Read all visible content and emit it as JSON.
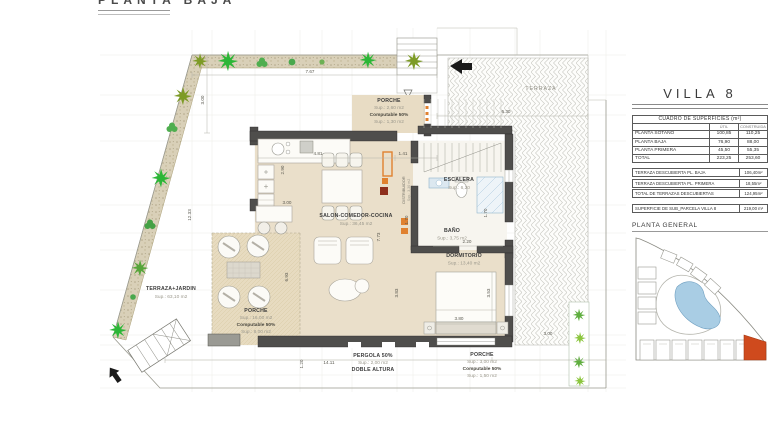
{
  "sheet": {
    "title": "PLANTA BAJA"
  },
  "plan": {
    "rooms": {
      "porche_top": {
        "name": "PORCHE",
        "sup": "Sup.: 2,60   m2",
        "comp": "Computable 50%",
        "comp_sup": "Sup.: 1,30   m2"
      },
      "salon": {
        "name": "SALON-COMEDOR-COCINA",
        "sup": "Sup.: 36,45 m2"
      },
      "escalera": {
        "name": "ESCALERA",
        "sup": "Sup.: 6,20"
      },
      "bano": {
        "name": "BAÑO",
        "sup": "Sup.: 3,75   m2"
      },
      "distribuidor": {
        "name": "DISTRIBUIDOR",
        "sup": "Sup.: 3,30  m2"
      },
      "dormitorio": {
        "name": "DORMITORIO",
        "sup": "Sup.: 13,40  m2"
      },
      "terraza_jardin": {
        "name": "TERRAZA+JARDIN",
        "sup": "Sup.: 63,10  m2"
      },
      "porche_left": {
        "name": "PORCHE",
        "sup": "Sup.: 16,00   m2",
        "comp": "Computable 50%",
        "comp_sup": "Sup.: 8,00    m2"
      },
      "terraza": {
        "name": "TERRAZA"
      },
      "pergola": {
        "name": "PERGOLA 50%",
        "sup": "Sup.: 2,00   m2",
        "name2": "DOBLE ALTURA"
      },
      "porche_bottom": {
        "name": "PORCHE",
        "sup": "Sup.: 3,00  m2",
        "comp": "Computable 50%",
        "comp_sup": "Sup.: 1,50  m2"
      }
    },
    "dims": [
      "7.67",
      "3.00",
      "12.33",
      "4.81",
      "1.41",
      "2.90",
      "7.73",
      "1.70",
      "2.20",
      "3.83",
      "3.53",
      "3.80",
      "6.30",
      "3.00",
      "14.11",
      "1.20",
      "6.93",
      "1.70",
      "3.00"
    ]
  },
  "panel": {
    "title": "VILLA 8",
    "surfaces_table": {
      "caption": "CUADRO DE SUPERFICIES (m²)",
      "col_util": "ÚTIL",
      "col_construida": "CONSTRUIDA",
      "rows": [
        {
          "label": "PLANTA SOTANO",
          "util": "100,85",
          "construida": "110,25"
        },
        {
          "label": "PLANTA BAJA",
          "util": "76,90",
          "construida": "88,00"
        },
        {
          "label": "PLANTA PRIMERA",
          "util": "45,50",
          "construida": "55,35"
        },
        {
          "label": "TOTAL",
          "util": "223,25",
          "construida": "253,60"
        }
      ]
    },
    "terrace_rows": [
      {
        "label": "TERRAZA DESCUBIERTA PL. BAJA",
        "value": "106,40m²"
      },
      {
        "label": "TERRAZA DESCUBIERTA PL. PRIMERA",
        "value": "18,55m²"
      },
      {
        "label": "TOTAL DE TERRAZAS DESCUBIERTAS",
        "value": "124,95m²"
      }
    ],
    "parcel_row": {
      "label": "SUPERFICIE DE SUB_PARCELA VILLA 8",
      "value": "219,00 m²"
    },
    "site_plan_title": "PLANTA GENERAL"
  },
  "colors": {
    "floor": "#eadfca",
    "wall": "#4f4e4c",
    "accent_orange": "#e0812f",
    "highlight_red": "#cf4a1d",
    "water": "#a9cde4",
    "plant_green": "#2cb637"
  }
}
